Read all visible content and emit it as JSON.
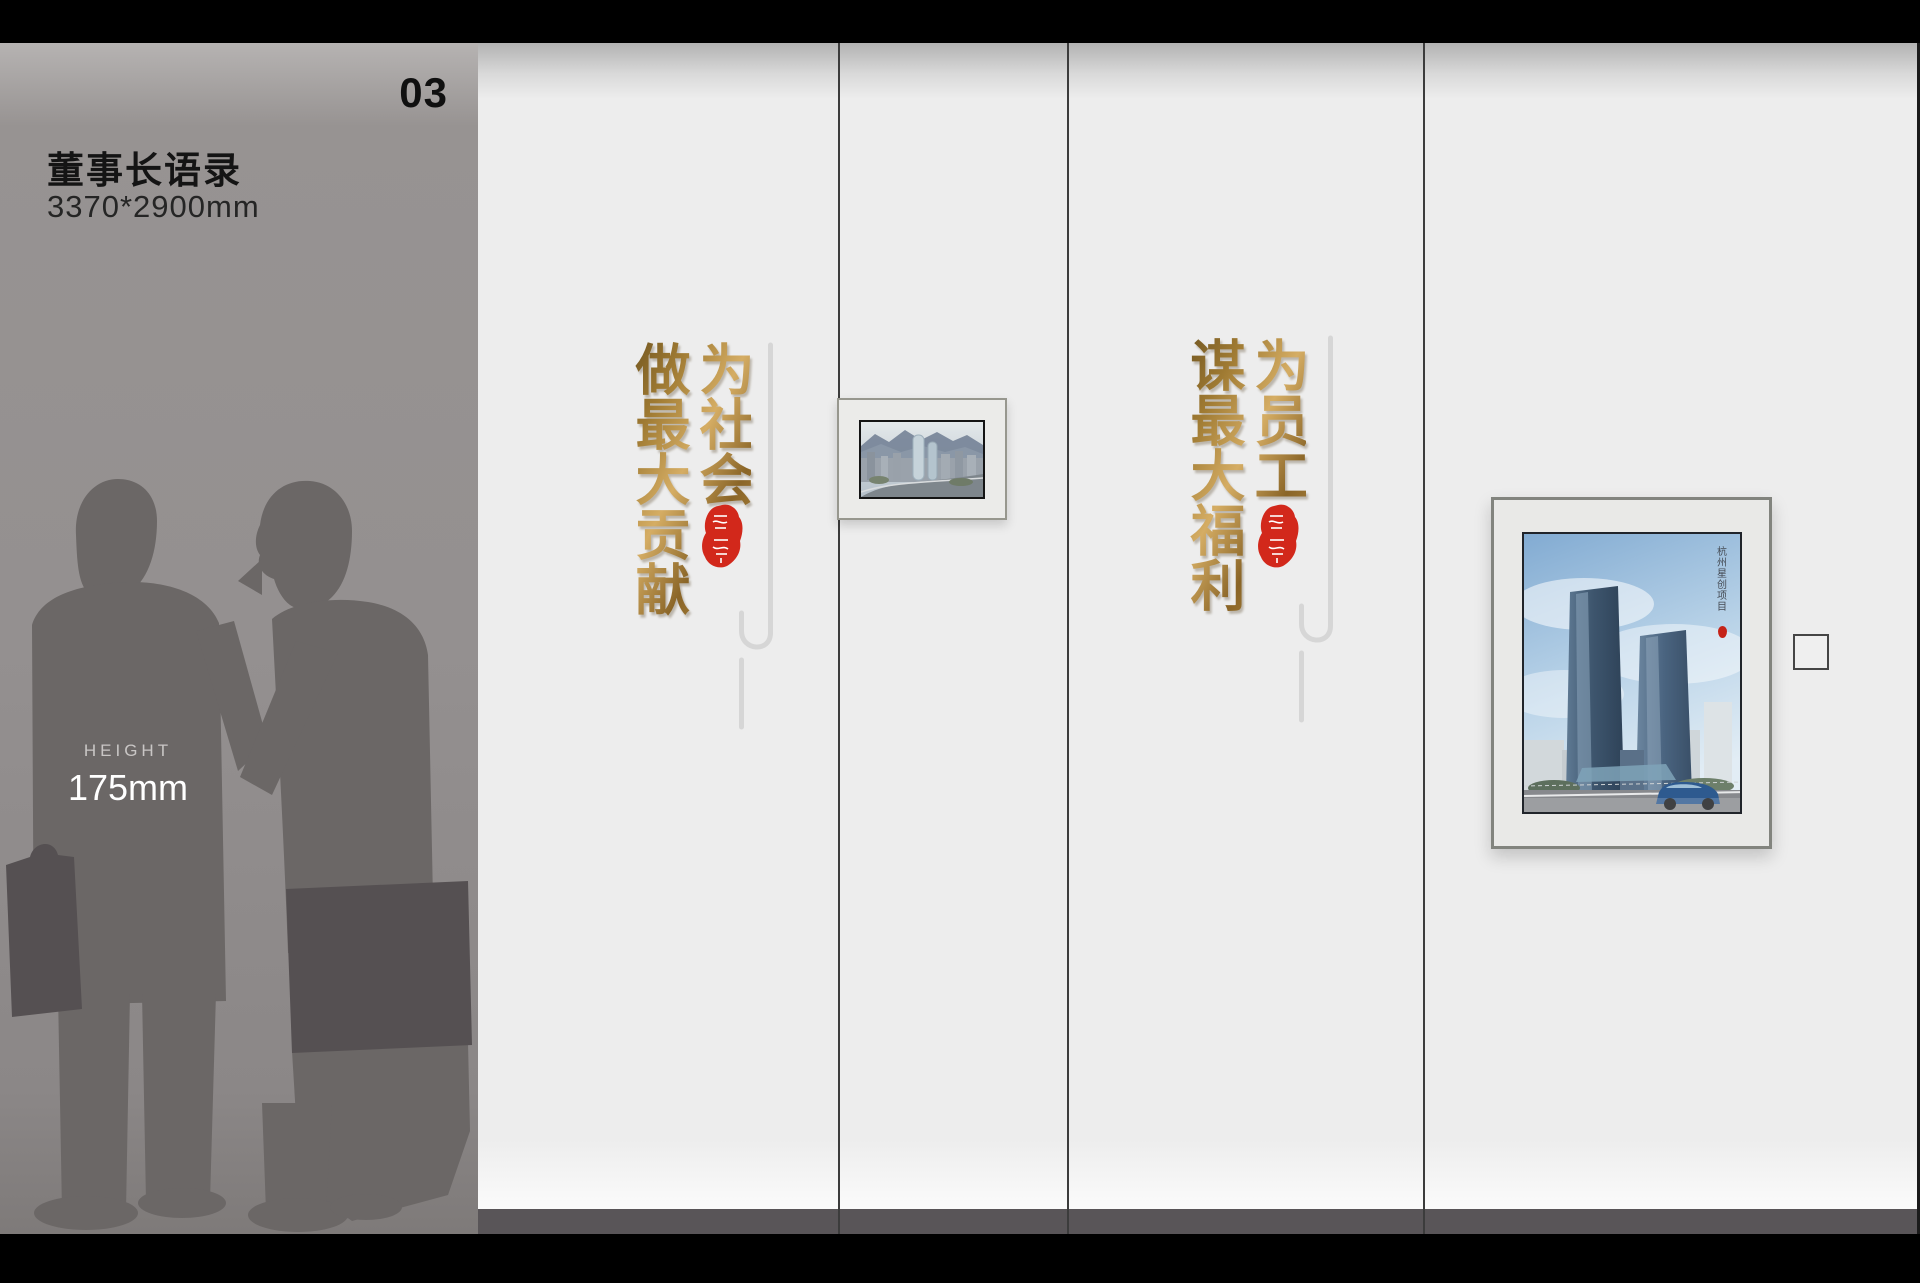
{
  "slide": {
    "number": "03"
  },
  "sidebar": {
    "title": "董事长语录",
    "dimensions": "3370*2900mm",
    "height_label": "HEIGHT",
    "height_value": "175mm"
  },
  "quotes": [
    {
      "right_column": "为社会",
      "left_column": "做最大贡献"
    },
    {
      "right_column": "为员工",
      "left_column": "谋最大福利"
    }
  ],
  "large_frame": {
    "caption": "杭州星创项目"
  },
  "colors": {
    "gold_dark": "#6f5420",
    "gold_light": "#d5ad64",
    "seal_red": "#d2281b",
    "wall": "#ededed",
    "baseboard": "#595558",
    "panel_gray": "#949090",
    "silhouette_gray": "#6b6766"
  }
}
